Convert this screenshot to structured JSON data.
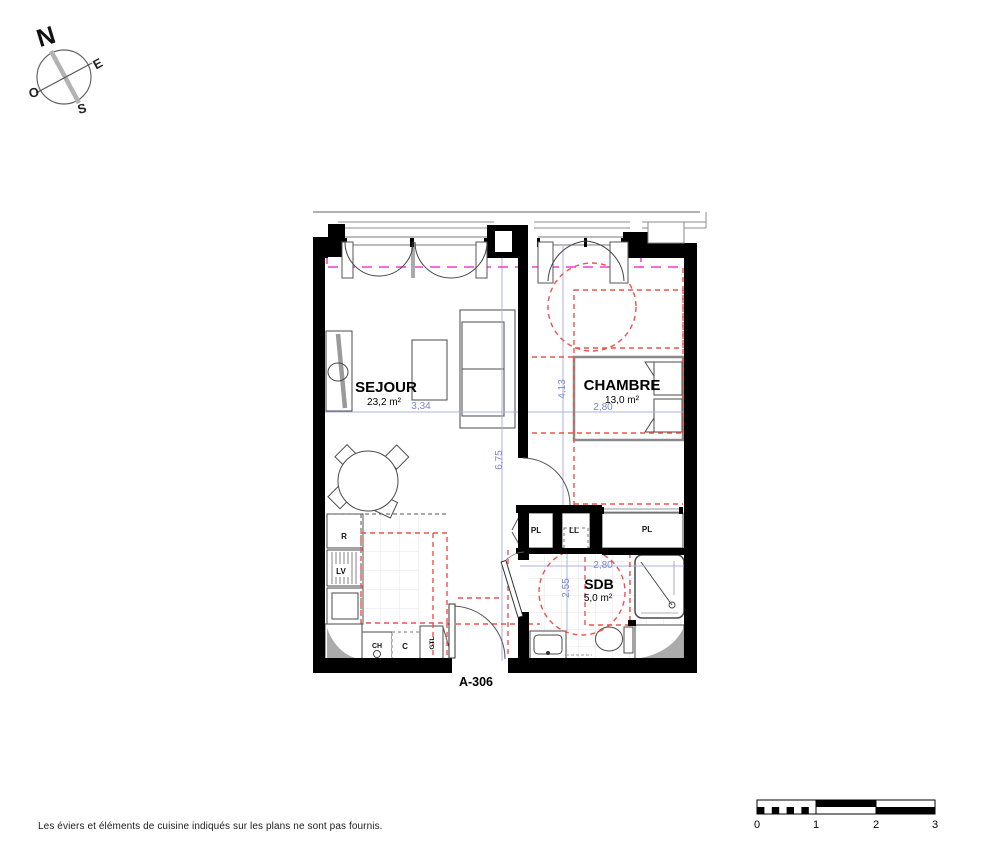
{
  "compass": {
    "north": "N",
    "east": "E",
    "south": "S",
    "west": "O"
  },
  "plan": {
    "unit_label": "A-306",
    "rooms": {
      "sejour": {
        "name": "SEJOUR",
        "area": "23,2 m²"
      },
      "chambre": {
        "name": "CHAMBRE",
        "area": "13,0 m²"
      },
      "sdb": {
        "name": "SDB",
        "area": "5,0 m²"
      }
    },
    "closets": {
      "pl_hall": "PL",
      "washer": "LL",
      "pl_chambre": "PL"
    },
    "kitchen": {
      "fridge": "R",
      "dishwasher": "LV",
      "water_heater": "CH",
      "c_unit": "C",
      "gtl": "GTL"
    },
    "dimensions": {
      "sejour_width": "3,34",
      "sejour_height": "6,75",
      "chambre_height": "4,13",
      "chambre_width": "2,80",
      "sdb_width": "2,80",
      "sdb_height": "2,55"
    }
  },
  "scale_bar": {
    "t0": "0",
    "t1": "1",
    "t2": "2",
    "t3": "3"
  },
  "footer": {
    "note": "Les éviers et éléments de cuisine indiqués sur les plans ne sont pas fournis."
  },
  "colors": {
    "wall": "#000000",
    "accessibility_red": "#f2504d",
    "boundary_magenta": "#ef3ed2",
    "dimension_blue": "#a9b1e3",
    "dimension_text_blue": "#7d88ce",
    "fixture_gray": "#9a9a9a",
    "tile_gray": "#e4e4e4"
  }
}
